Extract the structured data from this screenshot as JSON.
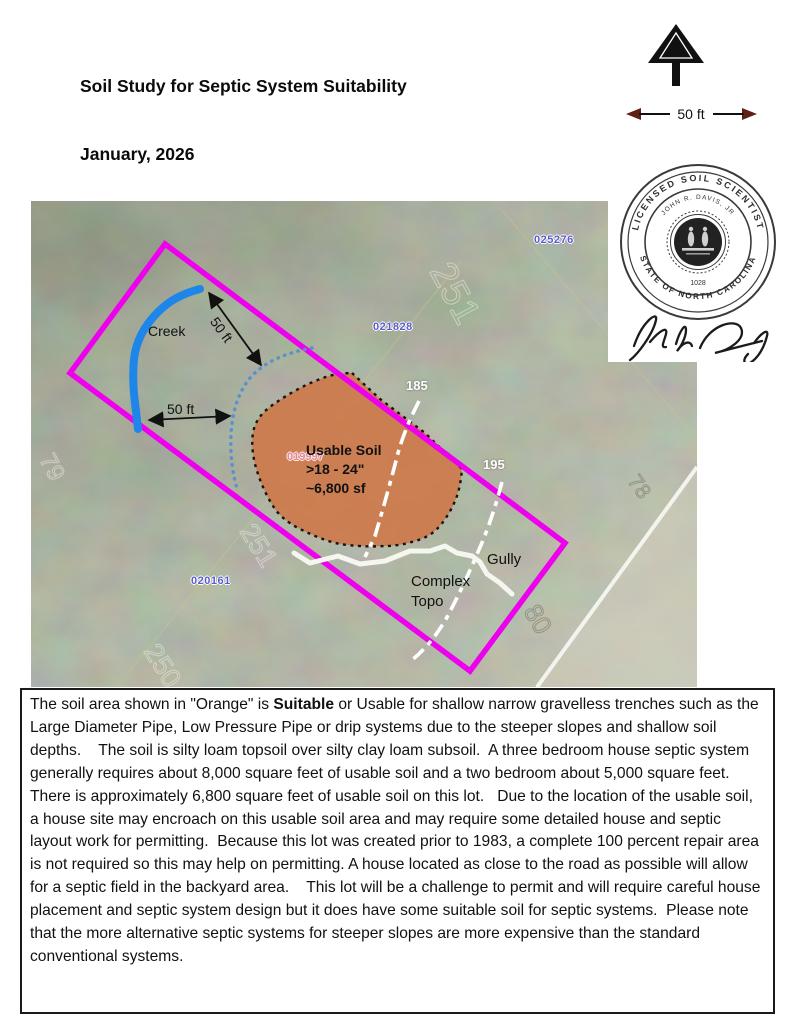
{
  "header": {
    "lines": [
      "Soil Study for Septic System Suitability",
      "January, 2026",
      "John R. Davis, Jr.  LSS",
      "104 Santee Drive   Parcel  019997",
      "Franklin County, NC"
    ]
  },
  "scale_bar": {
    "label": "50 ft"
  },
  "map": {
    "labels": {
      "creek": "Creek",
      "setback_rotated": "50 ft",
      "setback_horizontal": "50 ft",
      "contour_185": "185",
      "contour_195": "195",
      "gully": "Gully",
      "complex_topo_line1": "Complex",
      "complex_topo_line2": "Topo",
      "usable_soil_title": "Usable Soil",
      "usable_soil_depth": ">18 - 24\"",
      "usable_soil_area": "~6,800 sf",
      "parcel_pink": "019997"
    },
    "parcel_ids": [
      "025276",
      "021828",
      "020161"
    ],
    "photo_labels": [
      "79",
      "251",
      "251",
      "250",
      "78",
      "80"
    ],
    "colors": {
      "boundary": "#ee00ee",
      "creek": "#1e86e8",
      "setback_dotted": "#5a8fd0",
      "usable_soil_fill": "#cd7a4b",
      "contour_line": "#ffffff",
      "parcel_label": "#5b5bd0"
    }
  },
  "seal": {
    "outer_text_top": "LICENSED  SOIL  SCIENTIST",
    "inner_text_top": "JOHN  R.  DAVIS,  JR",
    "outer_text_bottom": "STATE  OF  NORTH  CAROLINA",
    "number": "1028"
  },
  "report": {
    "before_bold": "The soil area shown in \"Orange\" is ",
    "bold_word": "Suitable",
    "after_bold": " or Usable for shallow narrow gravelless trenches such as the Large Diameter Pipe, Low Pressure Pipe or drip systems due to the steeper slopes and shallow soil depths.    The soil is silty loam topsoil over silty clay loam subsoil.  A three bedroom house septic system generally requires about 8,000 square feet of usable soil and a two bedroom about 5,000 square feet.  There is approximately 6,800 square feet of usable soil on this lot.   Due to the location of the usable soil, a house site may encroach on this usable soil area and may require some detailed house and septic layout work for permitting.  Because this lot was created prior to 1983, a complete 100 percent repair area is not required so this may help on permitting. A house located as close to the road as possible will allow for a septic field in the backyard area.    This lot will be a challenge to permit and will require careful house placement and septic system design but it does have some suitable soil for septic systems.  Please note that the more alternative septic systems for steeper slopes are more expensive than the standard conventional systems."
  }
}
